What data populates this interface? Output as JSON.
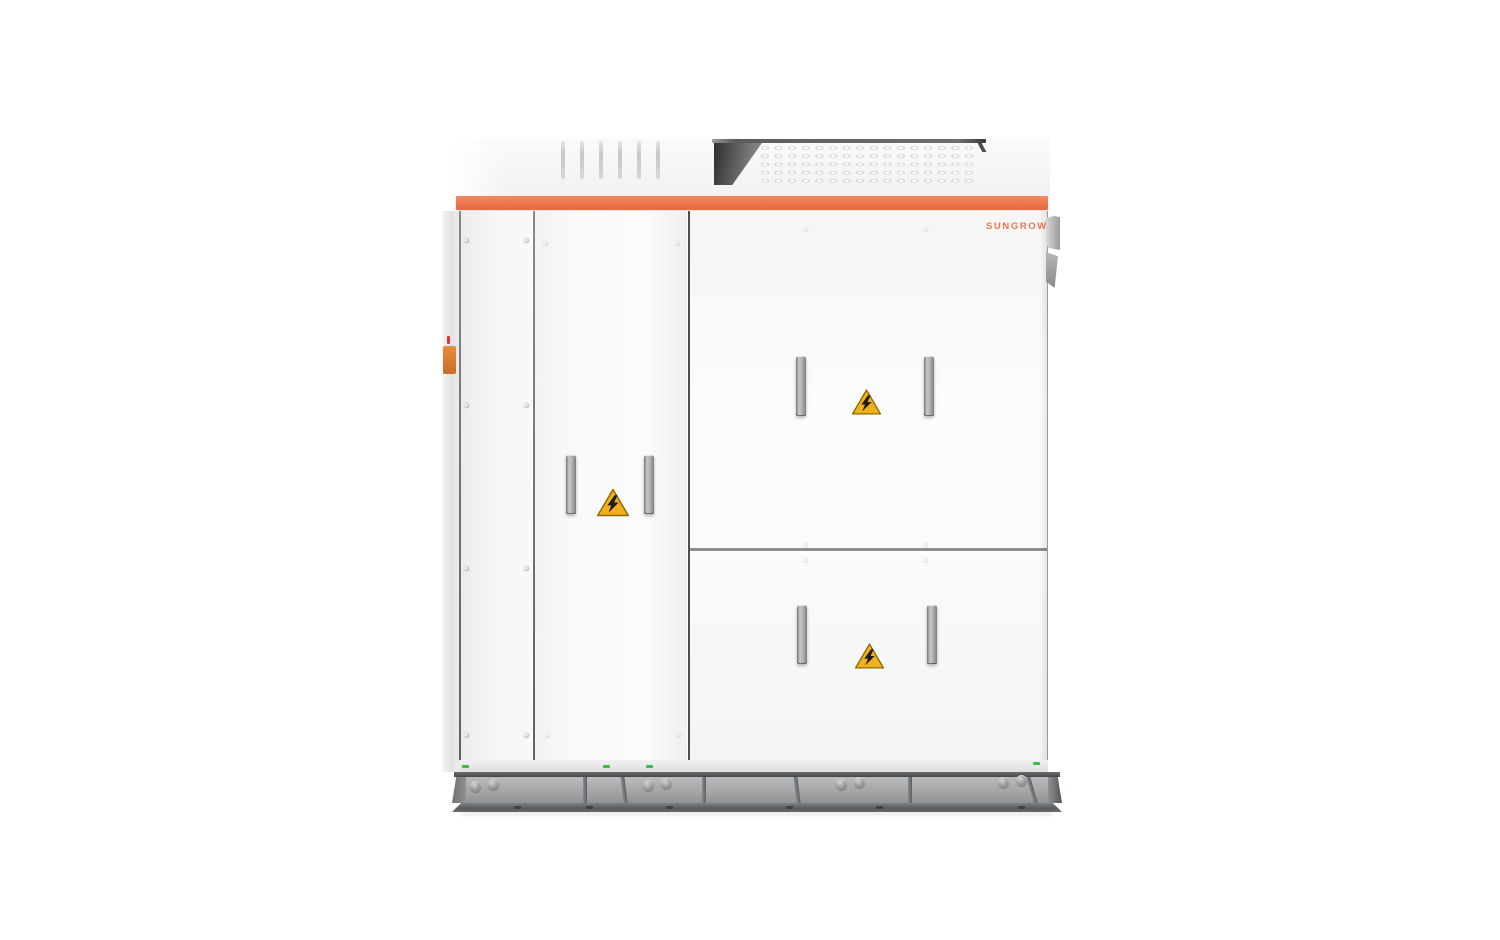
{
  "brand": {
    "logo_text": "SUNGROW",
    "logo_color": "#F0744A"
  },
  "colors": {
    "accent_orange": "#EC7B52",
    "warning_yellow": "#F2B01E",
    "warning_border": "#8A6D00",
    "cabinet_white": "#FAFAFB",
    "base_gray": "#A0A2A4",
    "green_indicator": "#3DBB4A",
    "side_gland_orange": "#D97A2E"
  },
  "icons": [
    {
      "name": "high-voltage-warning-icon",
      "glyph": "lightning-bolt-in-triangle",
      "count": 3,
      "locations": [
        "middle-door",
        "upper-right-door",
        "lower-right-door"
      ]
    }
  ],
  "cabinet": {
    "panels": [
      "left-service-panel",
      "middle-door",
      "upper-right-door",
      "lower-right-door"
    ],
    "handle_count": 6,
    "roof_features": [
      "vent-slats",
      "perforated-vent-grille"
    ],
    "base": "steel-skid-with-bolt-holes"
  }
}
